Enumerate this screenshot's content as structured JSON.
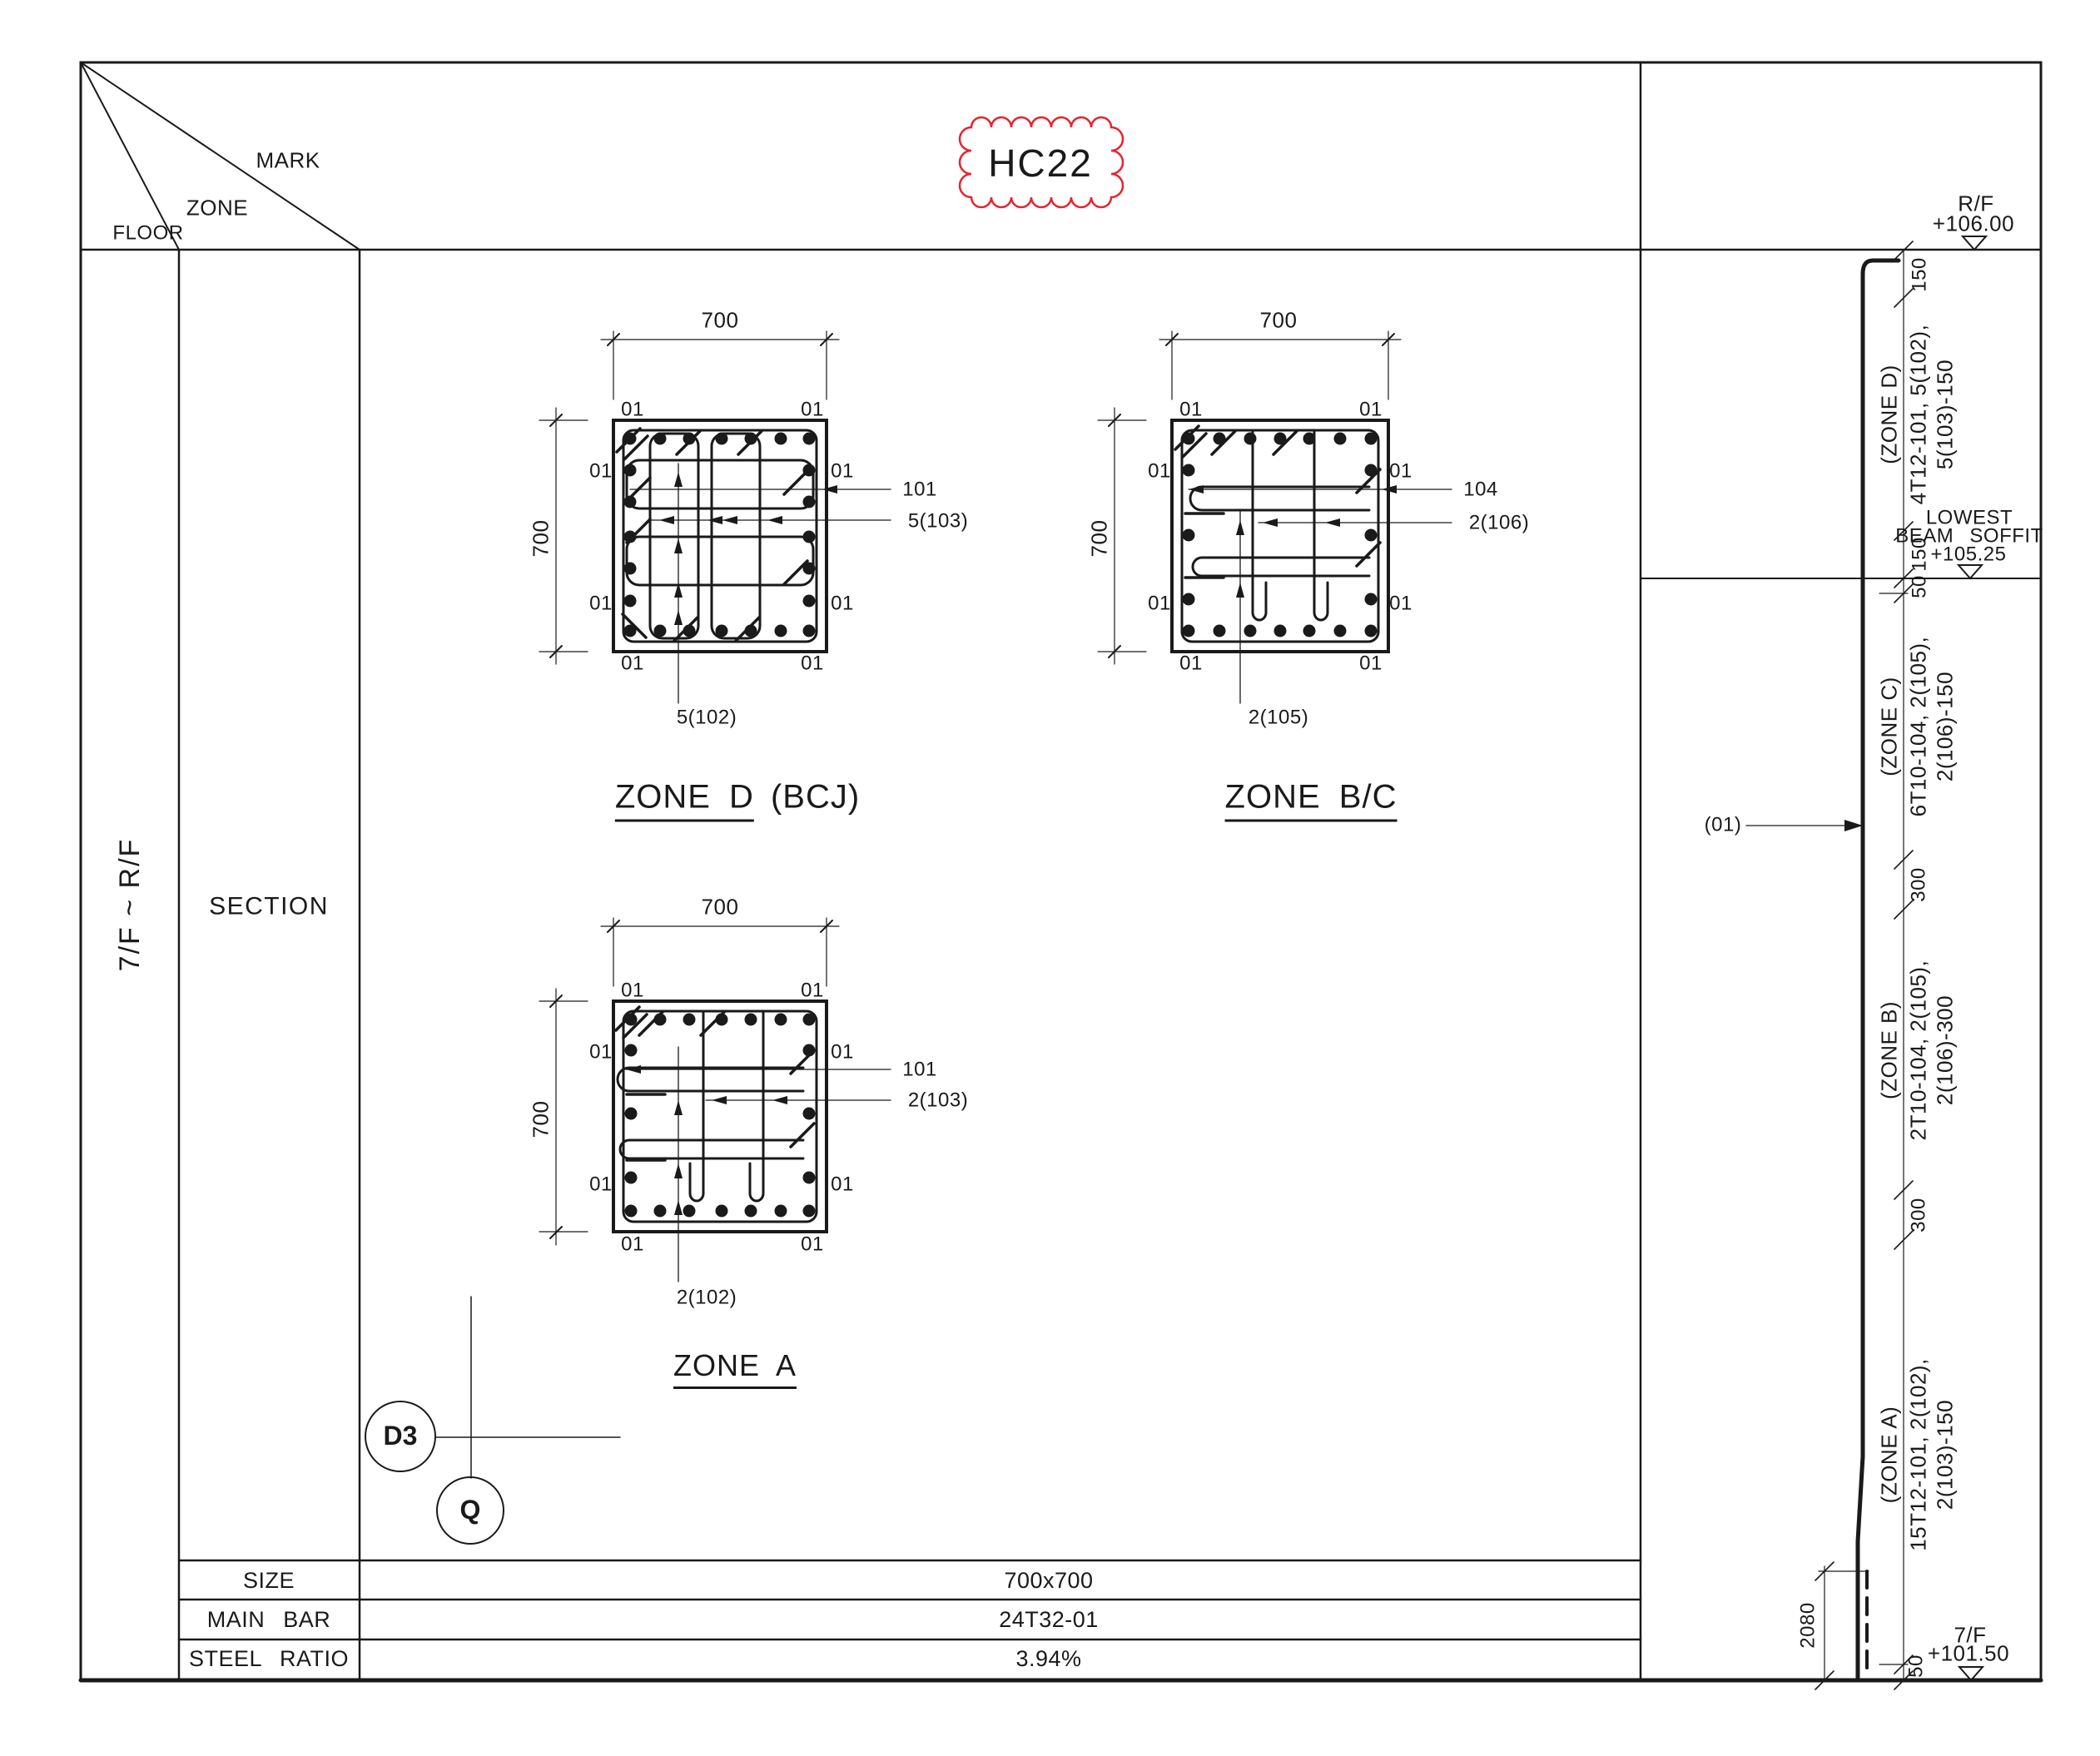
{
  "header": {
    "floor": "FLOOR",
    "zone": "ZONE",
    "mark": "MARK",
    "mark_value": "HC22"
  },
  "left": {
    "floor_range": "7/F ~ R/F",
    "section": "SECTION"
  },
  "summary": {
    "size_label": "SIZE",
    "size_value": "700x700",
    "main_bar_label": "MAIN BAR",
    "main_bar_value": "24T32-01",
    "steel_ratio_label": "STEEL RATIO",
    "steel_ratio_value": "3.94%"
  },
  "sections": [
    {
      "title_main": "ZONE D",
      "title_suffix": "(BCJ)",
      "dim_w": "700",
      "dim_h": "700",
      "bar": "01",
      "leader_top": "101",
      "leader_mid": "5(103)",
      "leader_bottom": "5(102)"
    },
    {
      "title_main": "ZONE B/C",
      "title_suffix": "",
      "dim_w": "700",
      "dim_h": "700",
      "bar": "01",
      "leader_top": "104",
      "leader_mid": "2(106)",
      "leader_bottom": "2(105)"
    },
    {
      "title_main": "ZONE A",
      "title_suffix": "",
      "dim_w": "700",
      "dim_h": "700",
      "bar": "01",
      "leader_top": "101",
      "leader_mid": "2(103)",
      "leader_bottom": "2(102)"
    }
  ],
  "elevation": {
    "levels": {
      "roof": {
        "name": "R/F",
        "value": "+106.00"
      },
      "soffit": {
        "line1": "LOWEST",
        "line2": "BEAM SOFFIT",
        "value": "+105.25"
      },
      "floor7": {
        "name": "7/F",
        "value": "+101.50"
      }
    },
    "zones": [
      {
        "name": "(ZONE D)",
        "spec1": "4T12-101, 5(102),",
        "spec2": "5(103)-150"
      },
      {
        "name": "(ZONE C)",
        "spec1": "6T10-104, 2(105),",
        "spec2": "2(106)-150"
      },
      {
        "name": "(ZONE B)",
        "spec1": "2T10-104, 2(105),",
        "spec2": "2(106)-300"
      },
      {
        "name": "(ZONE A)",
        "spec1": "15T12-101, 2(102),",
        "spec2": "2(103)-150"
      }
    ],
    "dims": {
      "d150_top": "150",
      "d150_soffit": "150",
      "d50_soffit": "50",
      "d300_cb": "300",
      "d300_ba": "300",
      "d2080": "2080",
      "d50_bottom": "50"
    },
    "bar_ref": "(01)"
  },
  "grid": {
    "bubble_d3": "D3",
    "bubble_q": "Q"
  },
  "colors": {
    "line": "#1a1a1a",
    "cloud": "#e8232d"
  }
}
